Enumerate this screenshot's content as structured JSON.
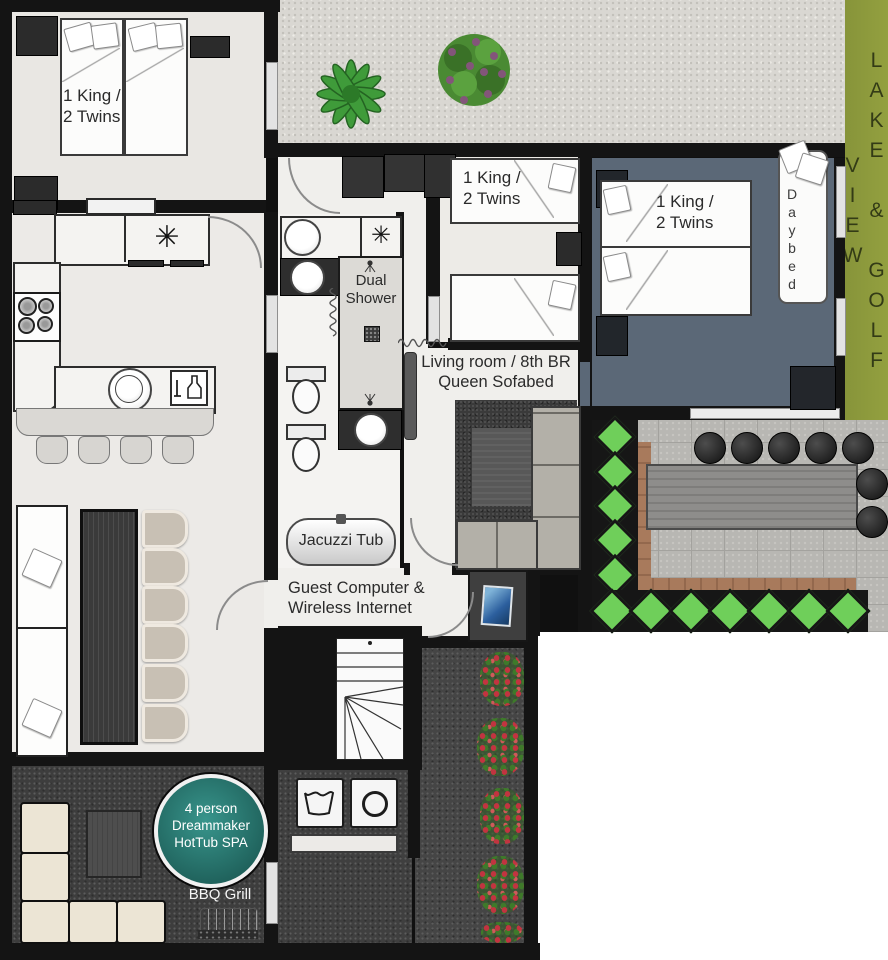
{
  "page": {
    "type": "vacation-home-floor-plan"
  },
  "labels": {
    "bedroom1": {
      "line1": "1 King /",
      "line2": "2 Twins"
    },
    "bedroom2": {
      "line1": "1 King /",
      "line2": "2 Twins"
    },
    "bedroom3": {
      "line1": "1 King /",
      "line2": "2 Twins"
    },
    "dual_shower": {
      "line1": "Dual",
      "line2": "Shower"
    },
    "living_room": {
      "line1": "Living room / 8th BR",
      "line2": "Queen Sofabed"
    },
    "jacuzzi": {
      "label": "Jacuzzi Tub"
    },
    "guest_computer": {
      "line1": "Guest Computer &",
      "line2": "Wireless Internet"
    },
    "hot_tub": {
      "line1": "4 person",
      "line2": "Dreammaker",
      "line3": "HotTub SPA"
    },
    "bbq": {
      "label": "BBQ Grill"
    },
    "daybed": {
      "label": "Daybed"
    },
    "view_strip": {
      "label": "LAKE & GOLF VIEW"
    }
  },
  "icons": {
    "ceiling_fan": "✳"
  },
  "colors": {
    "wall_black": "#141414",
    "hot_tub_teal": "#2a7b73",
    "grass_green": "#8d9a3b",
    "bedroom3_floor": "#5b6877",
    "hedge_green": "#6fcf5a",
    "brick_border": "#a87a5c",
    "flower_red": "#c23440",
    "gravel_light": "#d9d7d2",
    "patio_dark": "#454545"
  }
}
